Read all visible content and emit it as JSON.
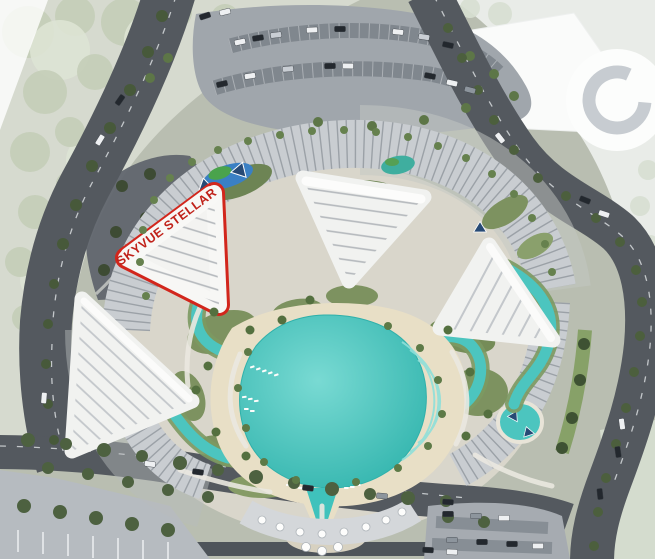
{
  "masterplan": {
    "highlighted_parcel": {
      "label": "SKYVUE STELLAR"
    }
  },
  "colors": {
    "accent": "#d2261c",
    "label": "#c0221a",
    "lagoon": "#3fc2bc",
    "lagoon_light": "#79dad3",
    "lagoon_deep": "#2fb3ac",
    "river": "#4cc5bf",
    "sand": "#e8dfc6",
    "road": "#54595f",
    "parking": "#a0a6ac",
    "building": "#f1f2f0",
    "podium": "#c9cdd1",
    "green": "#7d9260",
    "park_faded": "#d6dacf",
    "ne_faded": "#e9ece8"
  }
}
